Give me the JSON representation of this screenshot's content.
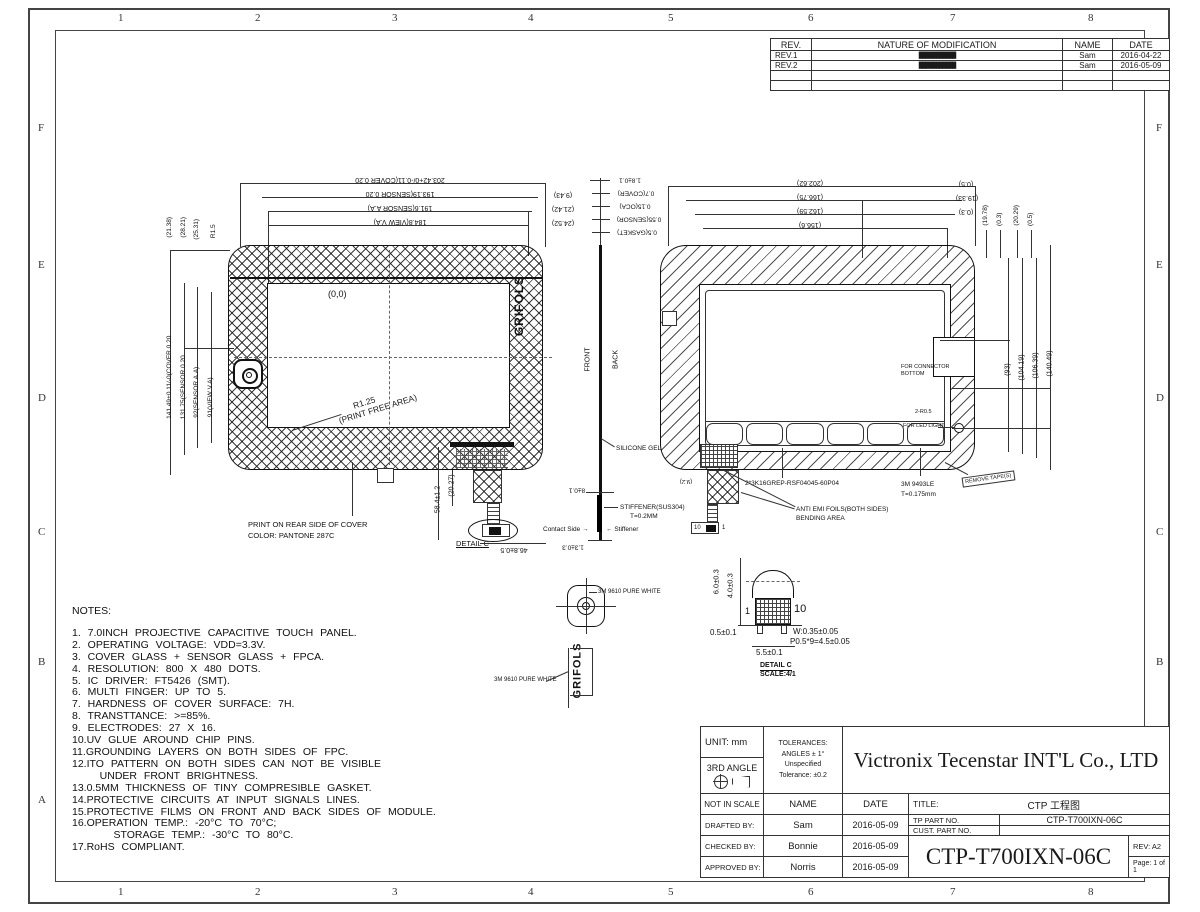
{
  "sheet": {
    "cols": [
      "1",
      "2",
      "3",
      "4",
      "5",
      "6",
      "7",
      "8"
    ],
    "rows": [
      "F",
      "E",
      "D",
      "C",
      "B",
      "A"
    ]
  },
  "revision_table": {
    "headers": [
      "REV.",
      "NATURE OF MODIFICATION",
      "NAME",
      "DATE"
    ],
    "rows": [
      {
        "rev": "REV.1",
        "modification": "███/████████",
        "name": "Sam",
        "date": "2016-04-22"
      },
      {
        "rev": "REV.2",
        "modification": "███/████████",
        "name": "Sam",
        "date": "2016-05-09"
      }
    ]
  },
  "notes": {
    "title": "NOTES:",
    "lines": [
      "1. 7.0INCH PROJECTIVE CAPACITIVE TOUCH PANEL.",
      "2. OPERATING VOLTAGE: VDD=3.3V.",
      "3. COVER GLASS + SENSOR GLASS + FPCA.",
      "4. RESOLUTION: 800 X 480 DOTS.",
      "5. IC DRIVER: FT5426 (SMT).",
      "6. MULTI FINGER: UP TO 5.",
      "7. HARDNESS OF COVER SURFACE: 7H.",
      "8. TRANSTTANCE: >=85%.",
      "9. ELECTRODES: 27 X 16.",
      "10.UV GLUE AROUND CHIP PINS.",
      "11.GROUNDING LAYERS ON BOTH SIDES OF FPC.",
      "12.ITO PATTERN ON BOTH SIDES CAN NOT BE VISIBLE",
      "    UNDER FRONT BRIGHTNESS.",
      "13.0.5MM THICKNESS OF TINY COMPRESIBLE GASKET.",
      "14.PROTECTIVE CIRCUITS AT INPUT SIGNALS LINES.",
      "15.PROTECTIVE FILMS ON FRONT AND BACK SIDES OF MODULE.",
      "16.OPERATION TEMP.: -20°C TO 70°C;",
      "      STORAGE TEMP.: -30°C TO 80°C.",
      "17.RoHS COMPLIANT."
    ]
  },
  "front_view": {
    "dims_top": [
      "203.42+0/-0.11(COVER 0.20",
      "193.19(SENSOR 0.20",
      "191.6(SENSOR A.A)",
      "184.8(VIEW V.A)"
    ],
    "dims_top_right": [
      "(9.43)",
      "(21.42)",
      "(24.52)"
    ],
    "dims_left_short": [
      "(21.38)",
      "(28.21)",
      "(25.31)",
      "R1.5"
    ],
    "dims_left_long": [
      "141.49+0.11/-0(COVER 0.20",
      "131.75(SENSOR 0.20",
      "92(SENSOR A.A)",
      "91(VIEW V.A)"
    ],
    "origin": "(0,0)",
    "radius_note": "R1.25",
    "radius_note2": "(PRINT FREE AREA)",
    "logo": "GRIFOLS",
    "print_note_line1": "PRINT ON REAR SIDE OF COVER",
    "print_note_line2": "COLOR: PANTONE 287C",
    "fpc_width_dim": "(20.27)",
    "fpc_drop_dim": "58.4±1.2",
    "fpc_bottom_dim": "46.8±0.5",
    "detail_c_ref": "DETAIL C"
  },
  "side_view": {
    "stack_dims": [
      "1.8±0.1",
      "0.7(COVER)",
      "0.15(OCA)",
      "0.55(SENSOR)",
      "0.5(GASKET)"
    ],
    "front_label": "FRONT",
    "back_label": "BACK",
    "silicone_label": "SILICONE GEL",
    "mid_dim": "8±0.1",
    "stiffener_note": "STIFFENER(SUS304)",
    "stiffener_thickness": "T=0.2MM",
    "contact_label": "Contact Side",
    "stiffener_label": "Stiffener",
    "bottom_dim": "1.3±0.3"
  },
  "back_view": {
    "dims_top": [
      "(202.62)",
      "(166.75)",
      "(162.59)",
      "(156.6)"
    ],
    "dims_top_right": [
      "(0.5)",
      "(19.33)",
      "(0.3)"
    ],
    "dims_top_right_rot": [
      "(19.78)",
      "(0.3)",
      "(20.29)",
      "(0.5)"
    ],
    "dims_right": [
      "(93)",
      "(104.19)",
      "(106.39)",
      "(140.49)"
    ],
    "connector_note_line1": "FOR CONNECTOR",
    "connector_note_line2": "BOTTOM",
    "corner_note": "2-R0.5",
    "led_note": "FOR LED LIGHT",
    "fpc_part_no": "2*3K16GREP-RSF04045-60P04",
    "tape_note_line1": "3M 9493LE",
    "tape_note_line2": "T=0.175mm",
    "emi_note_line1": "ANTI EMI FOILS(BOTH SIDES)",
    "emi_note_line2": "BENDING AREA",
    "remove_tape_note": "REMOVE TAPE(S)",
    "fpc_side_dim": "(9.2)",
    "pin_left": "10",
    "pin_right": "1"
  },
  "details": {
    "camera_tape_note": "3M 9610 PURE WHITE",
    "logo_tape_note": "3M 9610 PURE WHITE",
    "logo_text": "GRIFOLS",
    "connector": {
      "height_dim": "6.0±0.3",
      "height_dim2": "4.0±0.3",
      "pin1": "1",
      "pin10": "10",
      "side_dim": "0.5±0.1",
      "width_dim": "5.5±0.1",
      "pin_width": "W:0.35±0.05",
      "pitch": "P0.5*9=4.5±0.05",
      "label": "DETAIL C",
      "scale": "SCALE:4/1"
    }
  },
  "title_block": {
    "unit": "UNIT: mm",
    "angle": "3RD ANGLE",
    "tol1": "TOLERANCES:",
    "tol2": "ANGLES ± 1°",
    "tol3": "Unspecified",
    "tol4": "Tolerance: ±0.2",
    "company": "Victronix Tecenstar INT'L Co., LTD",
    "not_in_scale": "NOT IN SCALE",
    "name_h": "NAME",
    "date_h": "DATE",
    "title_label": "TITLE:",
    "title_value": "CTP 工程图",
    "tp_part_label": "TP PART NO.",
    "tp_part_value": "CTP-T700IXN-06C",
    "cust_part_label": "CUST. PART NO.",
    "cust_part_value": "",
    "drafted_label": "DRAFTED BY:",
    "drafted_name": "Sam",
    "drafted_date": "2016-05-09",
    "checked_label": "CHECKED BY:",
    "checked_name": "Bonnie",
    "checked_date": "2016-05-09",
    "approved_label": "APPROVED BY:",
    "approved_name": "Norris",
    "approved_date": "2016-05-09",
    "part_no_big": "CTP-T700IXN-06C",
    "rev": "REV:  A2",
    "page": "Page: 1 of 1"
  }
}
